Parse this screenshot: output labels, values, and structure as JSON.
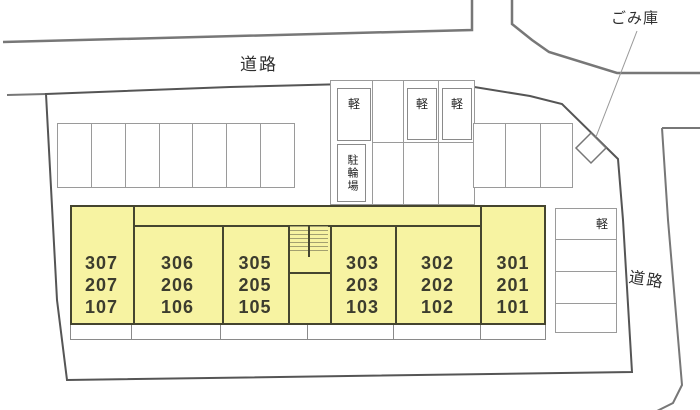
{
  "title": "apartment-site-plan",
  "labels": {
    "road_top": "道路",
    "road_right": "道路",
    "garbage_store": "ごみ庫",
    "kei_car": "軽",
    "bicycle_parking": "駐輪場"
  },
  "building": {
    "units": [
      {
        "id": "unit-307",
        "lines": [
          "307",
          "207",
          "107"
        ]
      },
      {
        "id": "unit-306",
        "lines": [
          "306",
          "206",
          "106"
        ]
      },
      {
        "id": "unit-305",
        "lines": [
          "305",
          "205",
          "105"
        ]
      },
      {
        "id": "unit-303",
        "lines": [
          "303",
          "203",
          "103"
        ]
      },
      {
        "id": "unit-302",
        "lines": [
          "302",
          "202",
          "102"
        ]
      },
      {
        "id": "unit-301",
        "lines": [
          "301",
          "201",
          "101"
        ]
      }
    ]
  },
  "parking": {
    "left_row_stalls": 7,
    "middle_group_kei_stalls": 3,
    "right_group_stalls": 3,
    "right_column_stalls": 4
  },
  "colors": {
    "background": "#ffffff",
    "building_fill": "#f7f3a2",
    "building_border": "#45452f",
    "road_line": "#777777",
    "boundary_line": "#555555",
    "parking_line": "#9a9a9a",
    "text": "#2e2e2e"
  }
}
